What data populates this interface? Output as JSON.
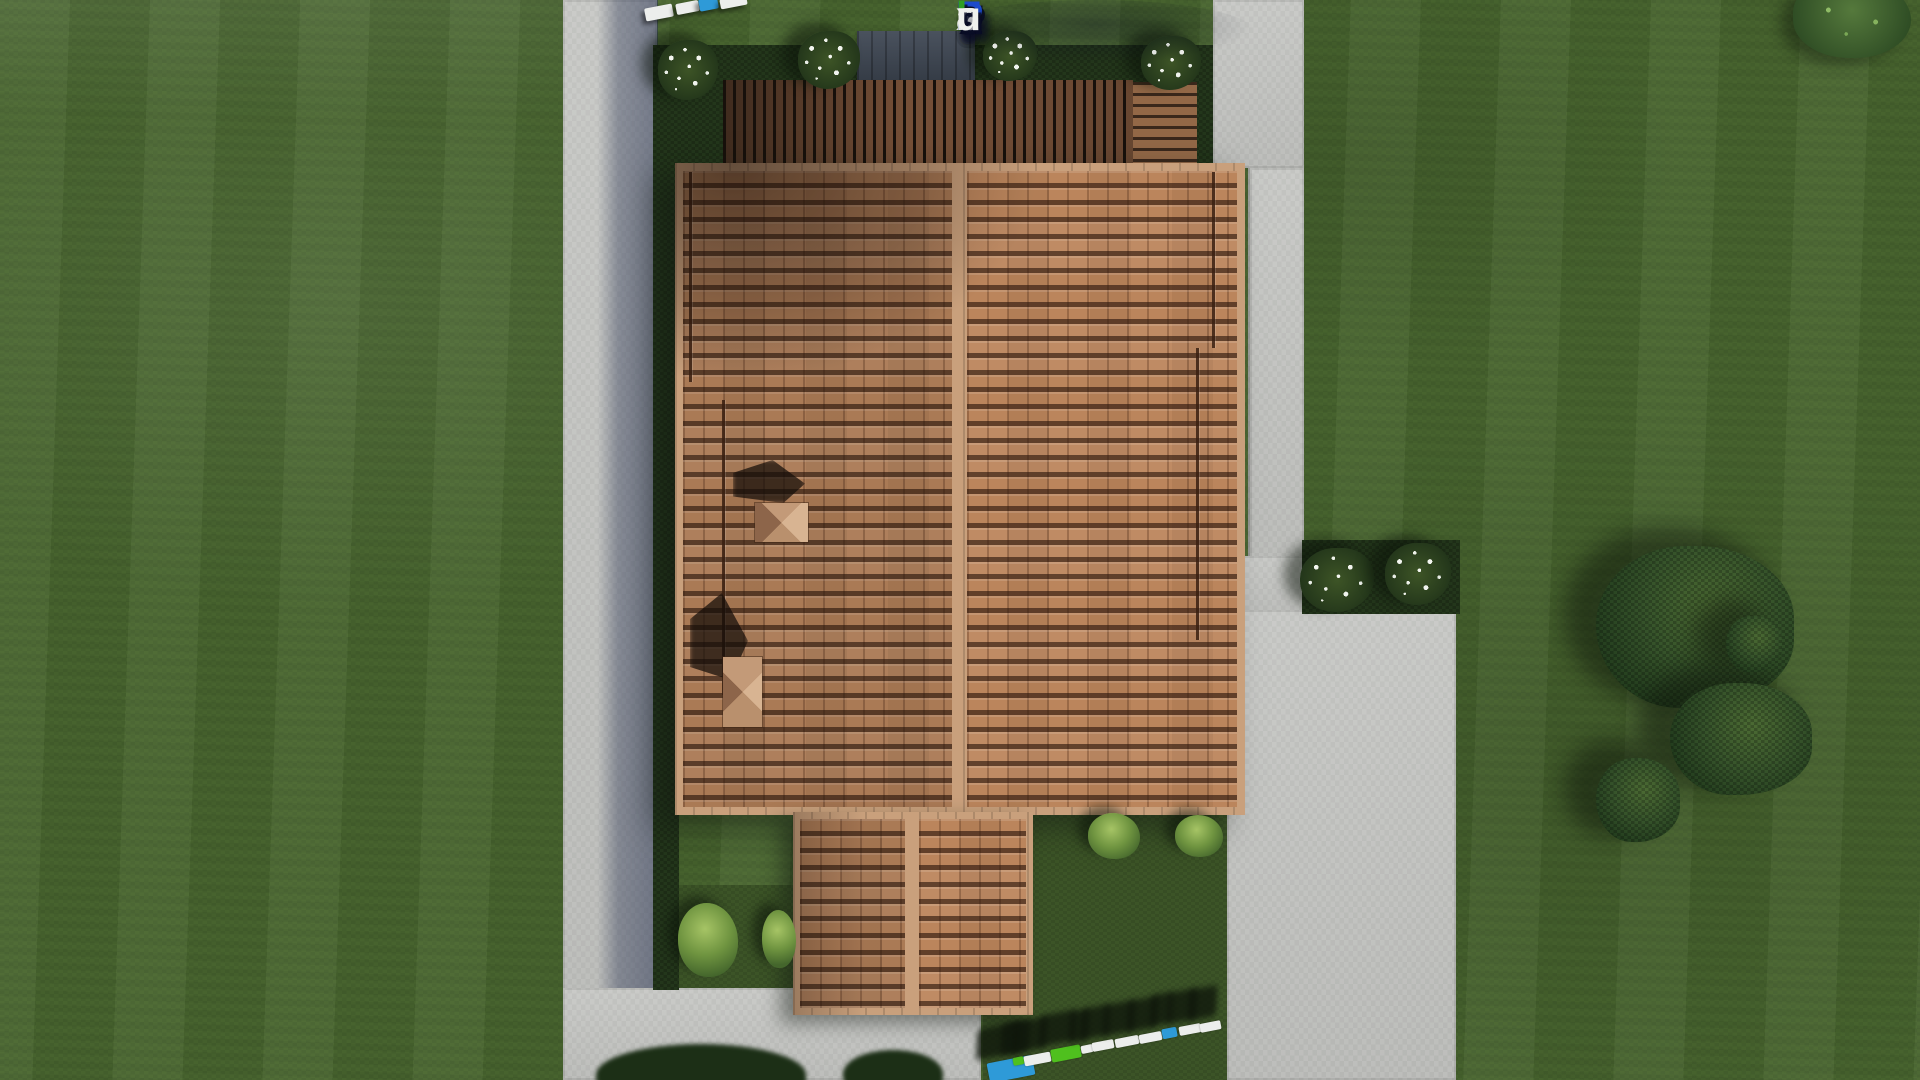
{
  "watermark": {
    "text": "FixPlans.ru",
    "letters": [
      {
        "ch": "F",
        "c": "blue"
      },
      {
        "ch": "i",
        "c": "green"
      },
      {
        "ch": "x",
        "c": "white"
      },
      {
        "ch": "P",
        "c": "blue"
      },
      {
        "ch": "l",
        "c": "green"
      },
      {
        "ch": "a",
        "c": "white"
      },
      {
        "ch": "n",
        "c": "white"
      },
      {
        "ch": "s",
        "c": "white"
      },
      {
        "ch": ".",
        "c": "blue"
      },
      {
        "ch": "r",
        "c": "white"
      },
      {
        "ch": "u",
        "c": "white"
      }
    ],
    "palette": {
      "blue": "#1e4ccc",
      "green": "#2f9e23",
      "white": "#f0f1ee"
    },
    "shadow_color": "#0a0e26"
  },
  "palette": {
    "grass": "#4a6730",
    "grass_dark": "#3c5427",
    "concrete_path": "#c7c8c5",
    "building_shadow": "#2c3654",
    "roof_tile": "#b38059",
    "roof_ridge": "#c9a07c",
    "pergola_wood": "#7f563c",
    "planting_bed": "#23361b",
    "tree_green": "#35522a",
    "bush_green": "#6f9440",
    "flower_white": "#f0f3ee"
  },
  "stones": {
    "colors": {
      "white": "#eceeec",
      "blue": "#2e9ad8",
      "green": "#4fc01e"
    },
    "bottom": [
      {
        "x": 988,
        "y": 1059,
        "w": 46,
        "h": 20,
        "c": "blue"
      },
      {
        "x": 1013,
        "y": 1057,
        "w": 11,
        "h": 8,
        "c": "green"
      },
      {
        "x": 1024,
        "y": 1054,
        "w": 27,
        "h": 10,
        "c": "white"
      },
      {
        "x": 1051,
        "y": 1047,
        "w": 30,
        "h": 13,
        "c": "green"
      },
      {
        "x": 1081,
        "y": 1045,
        "w": 12,
        "h": 8,
        "c": "white"
      },
      {
        "x": 1092,
        "y": 1041,
        "w": 22,
        "h": 9,
        "c": "white"
      },
      {
        "x": 1115,
        "y": 1037,
        "w": 24,
        "h": 9,
        "c": "white"
      },
      {
        "x": 1139,
        "y": 1033,
        "w": 23,
        "h": 9,
        "c": "white"
      },
      {
        "x": 1162,
        "y": 1028,
        "w": 15,
        "h": 10,
        "c": "blue"
      },
      {
        "x": 1179,
        "y": 1025,
        "w": 22,
        "h": 9,
        "c": "white"
      },
      {
        "x": 1200,
        "y": 1022,
        "w": 21,
        "h": 9,
        "c": "white"
      }
    ],
    "top": [
      {
        "x": 645,
        "y": 6,
        "w": 28,
        "h": 13,
        "c": "white"
      },
      {
        "x": 676,
        "y": 2,
        "w": 23,
        "h": 11,
        "c": "white"
      },
      {
        "x": 699,
        "y": -2,
        "w": 19,
        "h": 12,
        "c": "blue"
      },
      {
        "x": 720,
        "y": -3,
        "w": 27,
        "h": 10,
        "c": "white"
      }
    ]
  },
  "vegetation": {
    "items": [
      {
        "kind": "flower-bush",
        "x": 658,
        "y": 40,
        "w": 60,
        "h": 60
      },
      {
        "kind": "flower-bush",
        "x": 798,
        "y": 31,
        "w": 62,
        "h": 58
      },
      {
        "kind": "flower-bush",
        "x": 983,
        "y": 31,
        "w": 54,
        "h": 50
      },
      {
        "kind": "flower-bush",
        "x": 1141,
        "y": 36,
        "w": 60,
        "h": 54
      },
      {
        "kind": "flower-bush",
        "x": 1300,
        "y": 548,
        "w": 74,
        "h": 64
      },
      {
        "kind": "flower-bush",
        "x": 1385,
        "y": 543,
        "w": 66,
        "h": 62
      },
      {
        "kind": "green-bush",
        "x": 678,
        "y": 903,
        "w": 60,
        "h": 74
      },
      {
        "kind": "green-bush",
        "x": 762,
        "y": 910,
        "w": 34,
        "h": 58
      },
      {
        "kind": "green-bush",
        "x": 1088,
        "y": 813,
        "w": 52,
        "h": 46
      },
      {
        "kind": "green-bush",
        "x": 1175,
        "y": 815,
        "w": 48,
        "h": 42
      },
      {
        "kind": "tree",
        "x": 1596,
        "y": 546,
        "w": 198,
        "h": 162
      },
      {
        "kind": "tree",
        "x": 1670,
        "y": 683,
        "w": 142,
        "h": 112
      },
      {
        "kind": "tree",
        "x": 1596,
        "y": 758,
        "w": 84,
        "h": 84
      },
      {
        "kind": "tree",
        "x": 1726,
        "y": 616,
        "w": 56,
        "h": 56
      },
      {
        "kind": "leafy-tree",
        "x": 1793,
        "y": -22,
        "w": 118,
        "h": 80
      },
      {
        "kind": "canopy",
        "x": 596,
        "y": 1044,
        "w": 210,
        "h": 62
      },
      {
        "kind": "canopy",
        "x": 843,
        "y": 1050,
        "w": 100,
        "h": 48
      }
    ]
  }
}
